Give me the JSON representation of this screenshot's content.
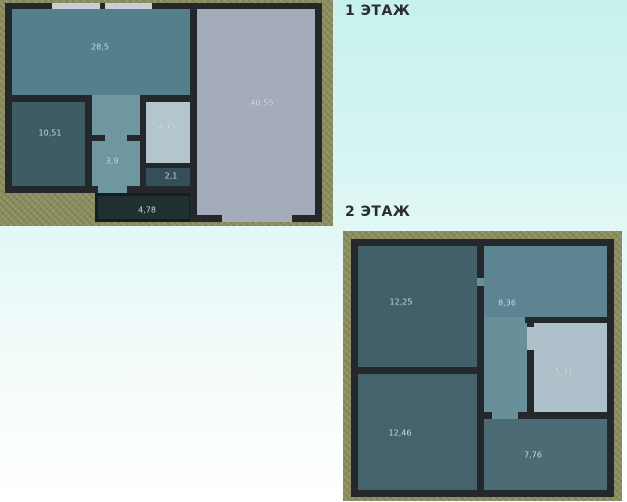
{
  "floor1": {
    "title": "1 ЭТАЖ",
    "rooms": [
      {
        "area": "28,5"
      },
      {
        "area": "10,51"
      },
      {
        "area": "3,9"
      },
      {
        "area": "4,75"
      },
      {
        "area": "2,1"
      },
      {
        "area": "4,78"
      },
      {
        "area": "40,55"
      }
    ]
  },
  "floor2": {
    "title": "2 ЭТАЖ",
    "rooms": [
      {
        "area": "12,25"
      },
      {
        "area": "8,36"
      },
      {
        "area": "5,31"
      },
      {
        "area": "12,46"
      },
      {
        "area": "7,76"
      }
    ]
  },
  "palette": {
    "bg-top": "#c7f1ee",
    "bg-bottom": "#ffffff",
    "ground": "#8e8e63",
    "wall": "#24282b",
    "window": "#c9cdd6",
    "title": "#2b2d2e",
    "room-28-5": "#55808b",
    "room-10-51": "#3e5c64",
    "room-3-9": "#6f97a1",
    "room-4-75": "#b5c5cd",
    "room-2-1": "#335059",
    "room-4-78": "#203031",
    "room-40-55": "#a4abba",
    "room-12-25": "#42606a",
    "room-8-36": "#5d8591",
    "room-8-36-hall": "#688f9a",
    "room-5-31": "#aec0ca",
    "room-12-46": "#44636d",
    "room-7-76": "#4c6b75"
  }
}
